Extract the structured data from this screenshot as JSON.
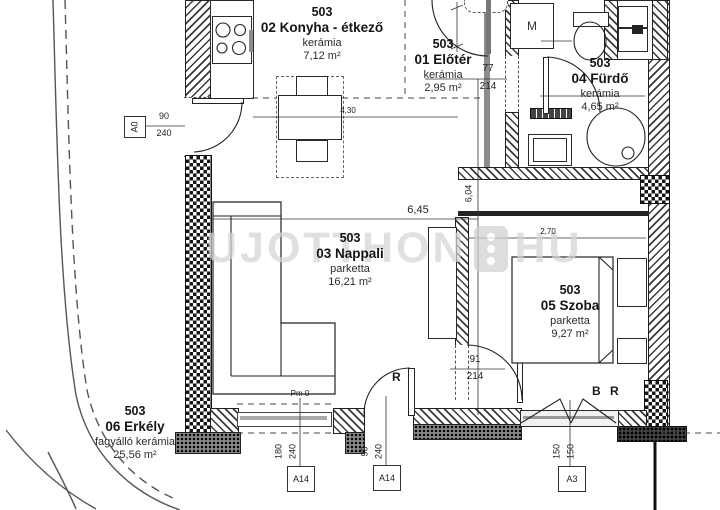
{
  "plan": {
    "watermark": {
      "brand_left": "UJOTTHON",
      "brand_right": "HU"
    },
    "rooms": [
      {
        "unit": "503",
        "name": "02 Konyha - étkező",
        "material": "kerámia",
        "area": "7,12 m²"
      },
      {
        "unit": "503",
        "name": "01 Előtér",
        "material": "kerámia",
        "area": "2,95 m²"
      },
      {
        "unit": "503",
        "name": "04 Fürdő",
        "material": "kerámia",
        "area": "4,65 m²"
      },
      {
        "unit": "503",
        "name": "03 Nappali",
        "material": "parketta",
        "area": "16,21 m²"
      },
      {
        "unit": "503",
        "name": "05 Szoba",
        "material": "parketta",
        "area": "9,27 m²"
      },
      {
        "unit": "503",
        "name": "06 Erkély",
        "material": "fagyálló kerámia",
        "area": "25,56 m²"
      }
    ],
    "dims": {
      "kitchen_width": "4,30",
      "living_width": "6,45",
      "living_depth": "6,04",
      "bedroom_width": "2,70",
      "door_bath_w": "77",
      "door_bath_h": "214",
      "door_bed_w": "91",
      "door_bed_h": "214",
      "door_entry_w": "90",
      "door_entry_h": "240",
      "slide_w": "180",
      "slide_h": "240",
      "door_balc_w": "90",
      "door_balc_h": "240",
      "win_w": "150",
      "win_h": "150"
    },
    "markers": {
      "entry": "A0",
      "balcony": "A14",
      "window": "A3",
      "pm": "Pm 0"
    },
    "labels": {
      "washer": "M",
      "r": "R",
      "br": "B R"
    }
  }
}
